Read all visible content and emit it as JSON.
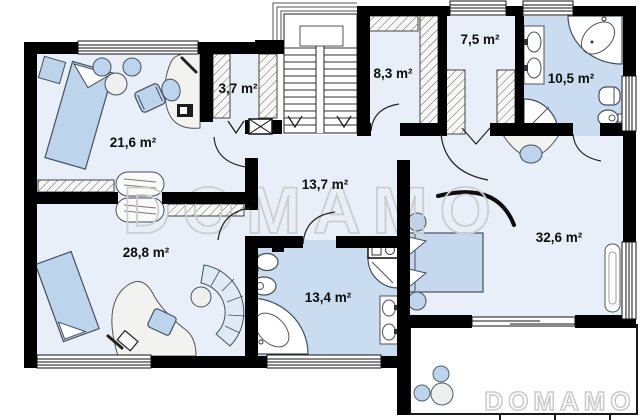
{
  "floorplan": {
    "watermark": {
      "text": "DOMAMO"
    },
    "rooms": [
      {
        "id": "bedroom-top-left",
        "area_label": "21,6 m²"
      },
      {
        "id": "closet-top-left",
        "area_label": "3,7 m²"
      },
      {
        "id": "wardrobe-room",
        "area_label": "8,3 m²"
      },
      {
        "id": "closet-top-right",
        "area_label": "7,5 m²"
      },
      {
        "id": "bathroom-top-right",
        "area_label": "10,5 m²"
      },
      {
        "id": "hall",
        "area_label": "13,7 m²"
      },
      {
        "id": "bedroom-bottom-left",
        "area_label": "28,8 m²"
      },
      {
        "id": "bathroom-bottom",
        "area_label": "13,4 m²"
      },
      {
        "id": "bedroom-right",
        "area_label": "32,6 m²"
      }
    ],
    "colors": {
      "wall": "#000000",
      "room_floor": "#e9eff9",
      "bathroom_floor": "#c9dcf0",
      "furniture_blue": "#bcd4ec",
      "furniture_gray": "#efefed",
      "watermark": "#cdcdcd"
    }
  }
}
